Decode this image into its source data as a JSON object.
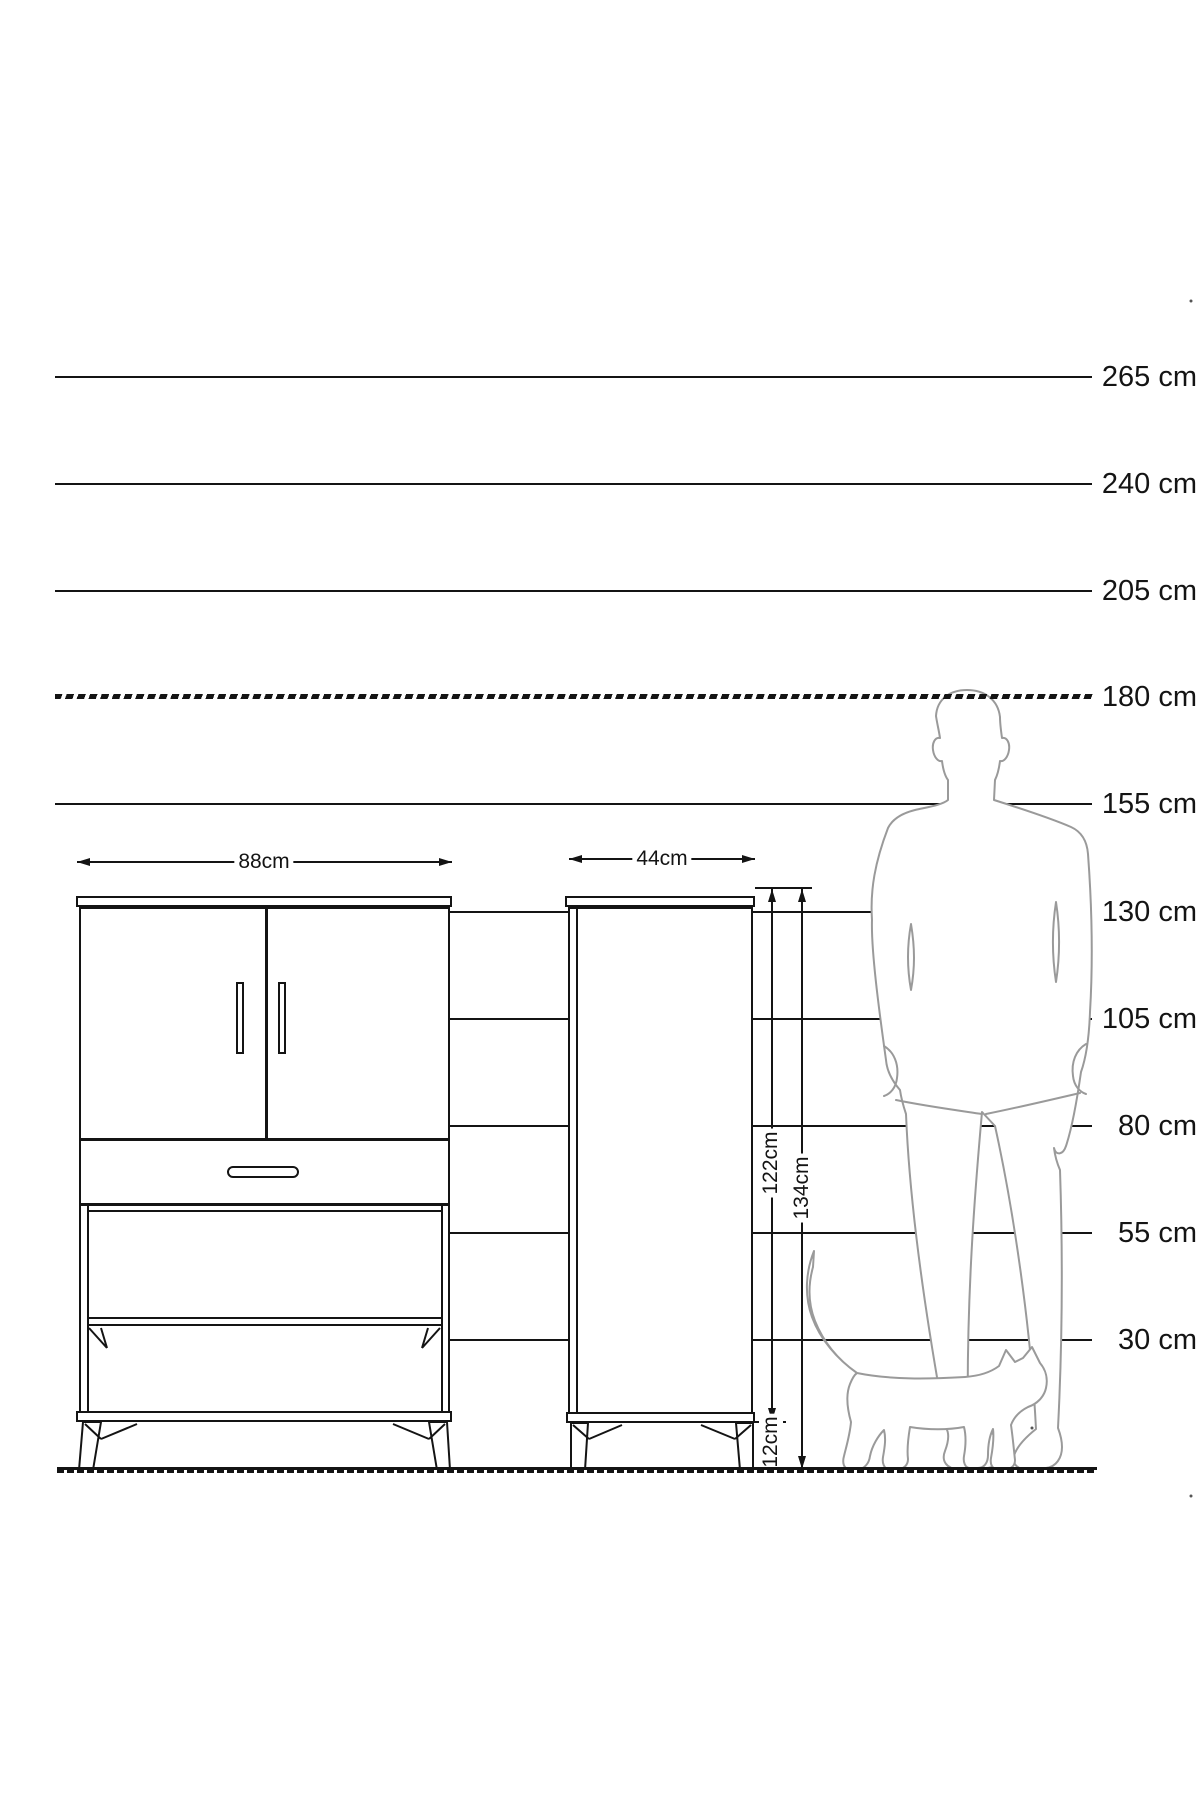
{
  "ruler": {
    "unit": "cm",
    "labels": [
      "265 cm",
      "240 cm",
      "205 cm",
      "180 cm",
      "155 cm",
      "130 cm",
      "105 cm",
      "80 cm",
      "55 cm",
      "30 cm"
    ],
    "values": [
      265,
      240,
      205,
      180,
      155,
      130,
      105,
      80,
      55,
      30
    ],
    "dashed_value": 180
  },
  "dimensions": {
    "cabinet_a_width": "88cm",
    "cabinet_b_width": "44cm",
    "cabinet_b_body_height": "122cm",
    "cabinet_b_total_height": "134cm",
    "cabinet_b_leg_height": "12cm"
  },
  "colors": {
    "line": "#141414",
    "figure_outline": "#9a9a9a",
    "background": "#ffffff"
  }
}
